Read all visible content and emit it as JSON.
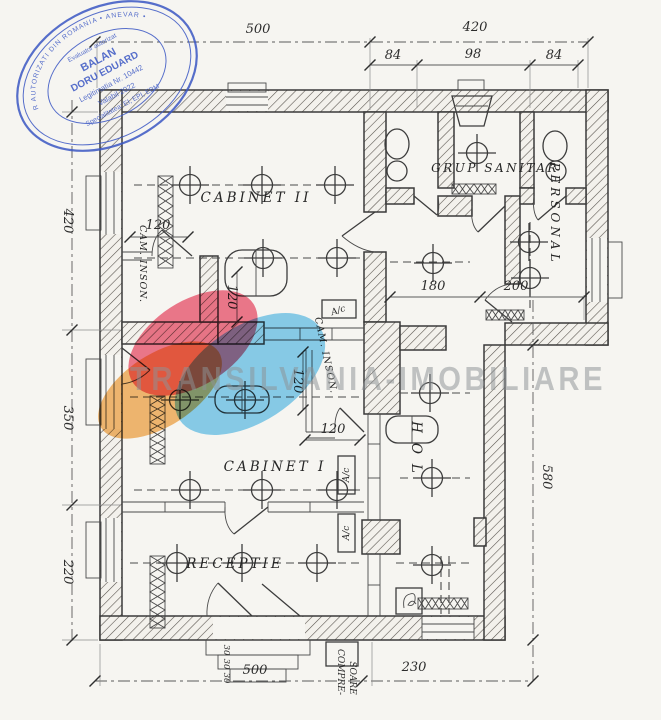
{
  "watermark": {
    "text": "TRANSILVANIA-IMOBILIARE"
  },
  "stamp": {
    "ring": "ASOCIATIA NATIONALA A EVALUATORILOR AUTORIZATI DIN ROMANIA • ANEVAR •",
    "role": "Evaluator autorizat",
    "name_line1": "BALAN",
    "name_line2": "DORU EDUARD",
    "license": "Legitimatia Nr. 10442",
    "valid": "Valabil 2022",
    "specialty": "Specialitatea: EI, EPI, EBM"
  },
  "rooms": {
    "cabinet2": "CABINET II",
    "cabinet1": "CABINET I",
    "receptie": "RECEPTIE",
    "grup_sanitar": "GRUP SANITAR",
    "personal": "PERSONAL",
    "hol": "HOL",
    "cam_inson_a": "CAM. INSON.",
    "cam_inson_b": "CAM. INSON."
  },
  "equipment": {
    "ac1": "A/c",
    "ac2": "A/c",
    "ac3": "A/c",
    "compresor_line1": "COMPRE-",
    "compresor_line2": "SOARE"
  },
  "dimensions": {
    "top_500": "500",
    "top_420": "420",
    "sub_84a": "84",
    "sub_98": "98",
    "sub_84b": "84",
    "left_420": "420",
    "left_350": "350",
    "left_220": "220",
    "right_580": "580",
    "bottom_500": "500",
    "bottom_230": "230",
    "cab2_120": "120",
    "booth1_120": "120",
    "booth2_120v": "120",
    "booth2_120h": "120",
    "hol_180": "180",
    "personal_200": "200",
    "step_a": "30",
    "step_b": "30",
    "step_c": "30"
  },
  "colors": {
    "paper": "#f6f5f1",
    "ink": "#3a3a3a",
    "stamp_blue": "#3b57c4",
    "watermark_gray": "#8d9396",
    "logo_orange": "#f4a94c",
    "logo_pink": "#ee5570",
    "logo_blue": "#5ec1ef"
  }
}
